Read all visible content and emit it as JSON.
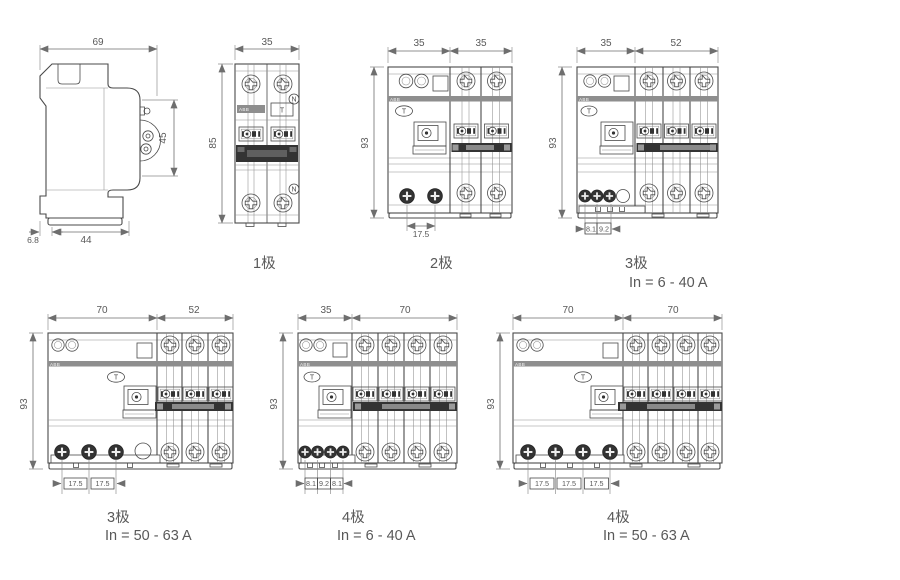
{
  "colors": {
    "background": "#ffffff",
    "line": "#4a4a4a",
    "dim_line": "#6e6e6e",
    "text": "#595959",
    "dark_fill": "#333333",
    "gray_bar": "#8e8e8e"
  },
  "brand": "ABB",
  "symbols": {
    "test_button": "T",
    "neutral": "N"
  },
  "figures": {
    "side_view": {
      "dim_width": "69",
      "dim_terminal_height": "45",
      "dim_clip_depth": "6.8",
      "dim_base_width": "44"
    },
    "pole1": {
      "label": "1极",
      "dim_width": "35",
      "dim_height": "85"
    },
    "pole2": {
      "label": "2极",
      "dim_left_width": "35",
      "dim_right_width": "35",
      "dim_height": "93",
      "dim_pitch": "17.5"
    },
    "pole3_small": {
      "label": "3极",
      "sublabel": "In = 6 - 40 A",
      "dim_left_width": "35",
      "dim_right_width": "52",
      "dim_height": "93",
      "dim_pitch_1": "8.1",
      "dim_pitch_2": "9.2"
    },
    "pole3_large": {
      "label": "3极",
      "sublabel": "In = 50 - 63 A",
      "dim_left_width": "70",
      "dim_right_width": "52",
      "dim_height": "93",
      "dim_pitch_1": "17.5",
      "dim_pitch_2": "17.5"
    },
    "pole4_small": {
      "label": "4极",
      "sublabel": "In = 6 - 40 A",
      "dim_left_width": "35",
      "dim_right_width": "70",
      "dim_height": "93",
      "dim_pitch_1": "8.1",
      "dim_pitch_2": "9.2",
      "dim_pitch_3": "8.1"
    },
    "pole4_large": {
      "label": "4极",
      "sublabel": "In = 50 - 63 A",
      "dim_left_width": "70",
      "dim_right_width": "70",
      "dim_height": "93",
      "dim_pitch_1": "17.5",
      "dim_pitch_2": "17.5",
      "dim_pitch_3": "17.5"
    }
  }
}
